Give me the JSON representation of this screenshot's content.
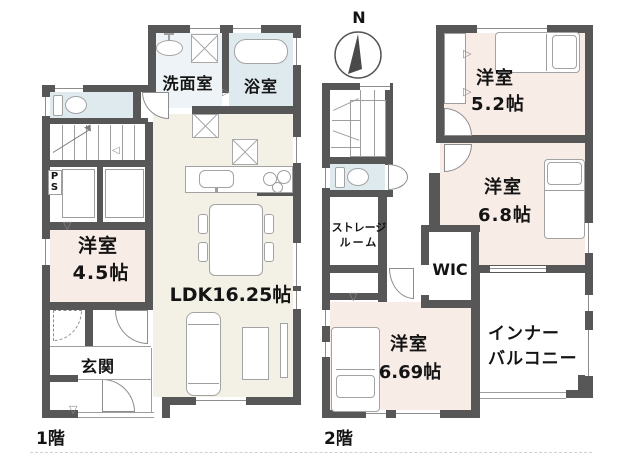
{
  "colors": {
    "wall": "#575757",
    "pink": "#f8ece6",
    "beige": "#f3f0e5",
    "blue": "#dfeaef",
    "blue2": "#edf3f6",
    "line": "#9e9e9e",
    "thin": "#8d8d8d",
    "text": "#141414"
  },
  "floor1": {
    "floor_label": "1階",
    "rooms": {
      "washroom": "洗面室",
      "bathroom": "浴室",
      "western_name": "洋室",
      "western_size": "4.5帖",
      "ldk": "LDK16.25帖",
      "entrance": "玄関",
      "pipe_space": "PS"
    }
  },
  "floor2": {
    "floor_label": "2階",
    "compass": "N",
    "rooms": {
      "r52_name": "洋室",
      "r52_size": "5.2帖",
      "r68_name": "洋室",
      "r68_size": "6.8帖",
      "storage_line1": "ストレージ",
      "storage_line2": "ルーム",
      "wic": "WIC",
      "r669_name": "洋室",
      "r669_size": "6.69帖",
      "balcony_line1": "インナー",
      "balcony_line2": "バルコニー"
    }
  },
  "icons": {
    "fold_right": "▷",
    "fold_down": "▽",
    "fold_left": "◁"
  }
}
